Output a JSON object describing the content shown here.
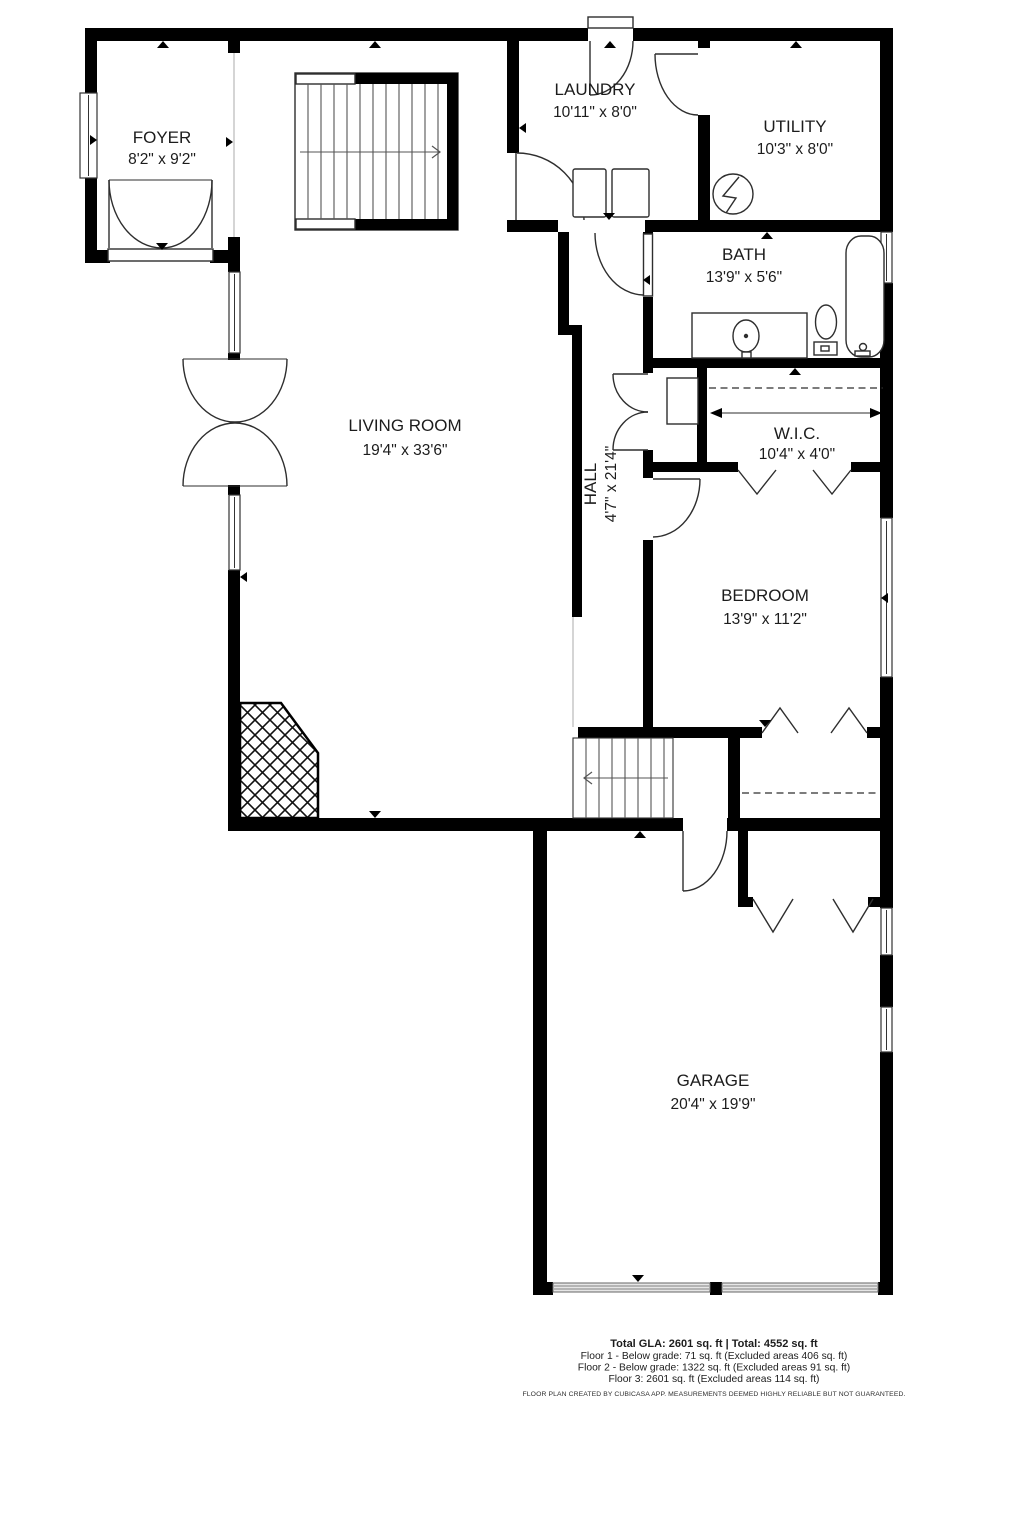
{
  "rooms": [
    {
      "name": "FOYER",
      "dims": "8'2\" x 9'2\""
    },
    {
      "name": "LAUNDRY",
      "dims": "10'11\" x 8'0\""
    },
    {
      "name": "UTILITY",
      "dims": "10'3\" x 8'0\""
    },
    {
      "name": "BATH",
      "dims": "13'9\" x 5'6\""
    },
    {
      "name": "LIVING ROOM",
      "dims": "19'4\" x 33'6\""
    },
    {
      "name": "HALL",
      "dims": "4'7\" x 21'4\""
    },
    {
      "name": "W.I.C.",
      "dims": "10'4\" x 4'0\""
    },
    {
      "name": "BEDROOM",
      "dims": "13'9\" x 11'2\""
    },
    {
      "name": "GARAGE",
      "dims": "20'4\" x 19'9\""
    }
  ],
  "footer": {
    "total": "Total GLA: 2601 sq. ft | Total: 4552 sq. ft",
    "floor1": "Floor 1 - Below grade: 71 sq. ft (Excluded areas 406 sq. ft)",
    "floor2": "Floor 2 - Below grade: 1322 sq. ft (Excluded areas 91 sq. ft)",
    "floor3": "Floor 3: 2601 sq. ft (Excluded areas 114 sq. ft)",
    "disclaimer": "FLOOR PLAN CREATED BY CUBICASA APP. MEASUREMENTS DEEMED HIGHLY RELIABLE BUT NOT GUARANTEED."
  },
  "colors": {
    "wall": "#000000",
    "line": "#2e2e2e",
    "text": "#1c1c1c",
    "background": "#ffffff",
    "garage_door": "#979797"
  }
}
